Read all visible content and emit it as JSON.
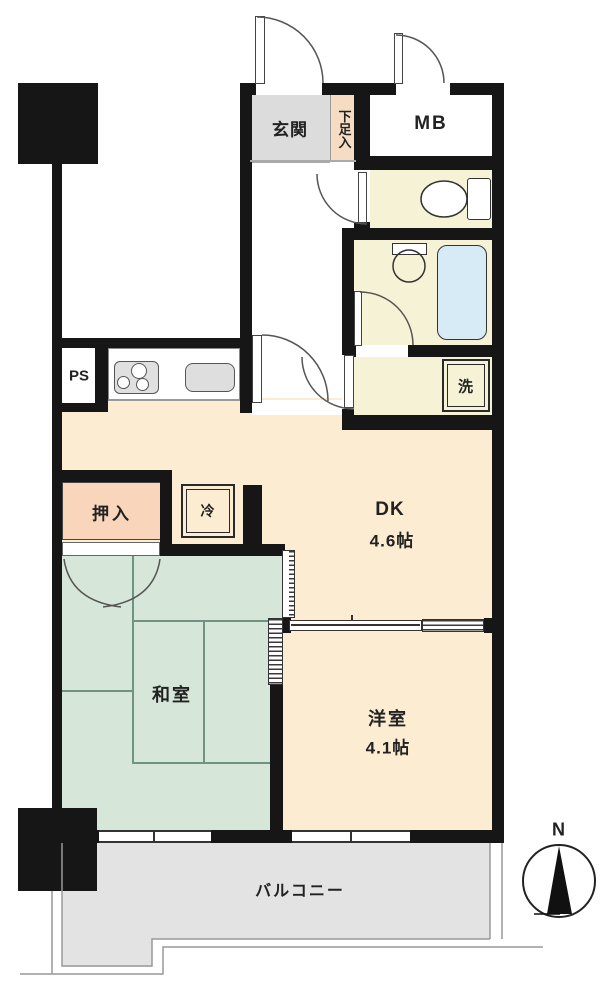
{
  "floorplan": {
    "rooms": {
      "genkan": "玄関",
      "shoe_storage": "下足入",
      "meter_box": "MB",
      "pipe_space": "PS",
      "washing_machine": "洗",
      "closet": "押入",
      "refrigerator": "冷",
      "dining_kitchen": "DK",
      "dining_kitchen_size": "4.6帖",
      "japanese_room": "和室",
      "western_room": "洋室",
      "western_room_size": "4.1帖",
      "balcony": "バルコニー"
    },
    "compass": {
      "north_label": "N"
    },
    "colors": {
      "wall": "#161616",
      "dk_floor": "#fcecd2",
      "tatami_floor": "#d6e7d9",
      "tatami_line": "#6f9383",
      "wet_area_floor": "#f6f2d6",
      "bathtub": "#d7ebf6",
      "genkan_floor": "#dcdcdc",
      "shoe_box": "#f5dcc2",
      "oshiire": "#f8d5bb",
      "balcony_floor": "#e3e3e3"
    }
  }
}
